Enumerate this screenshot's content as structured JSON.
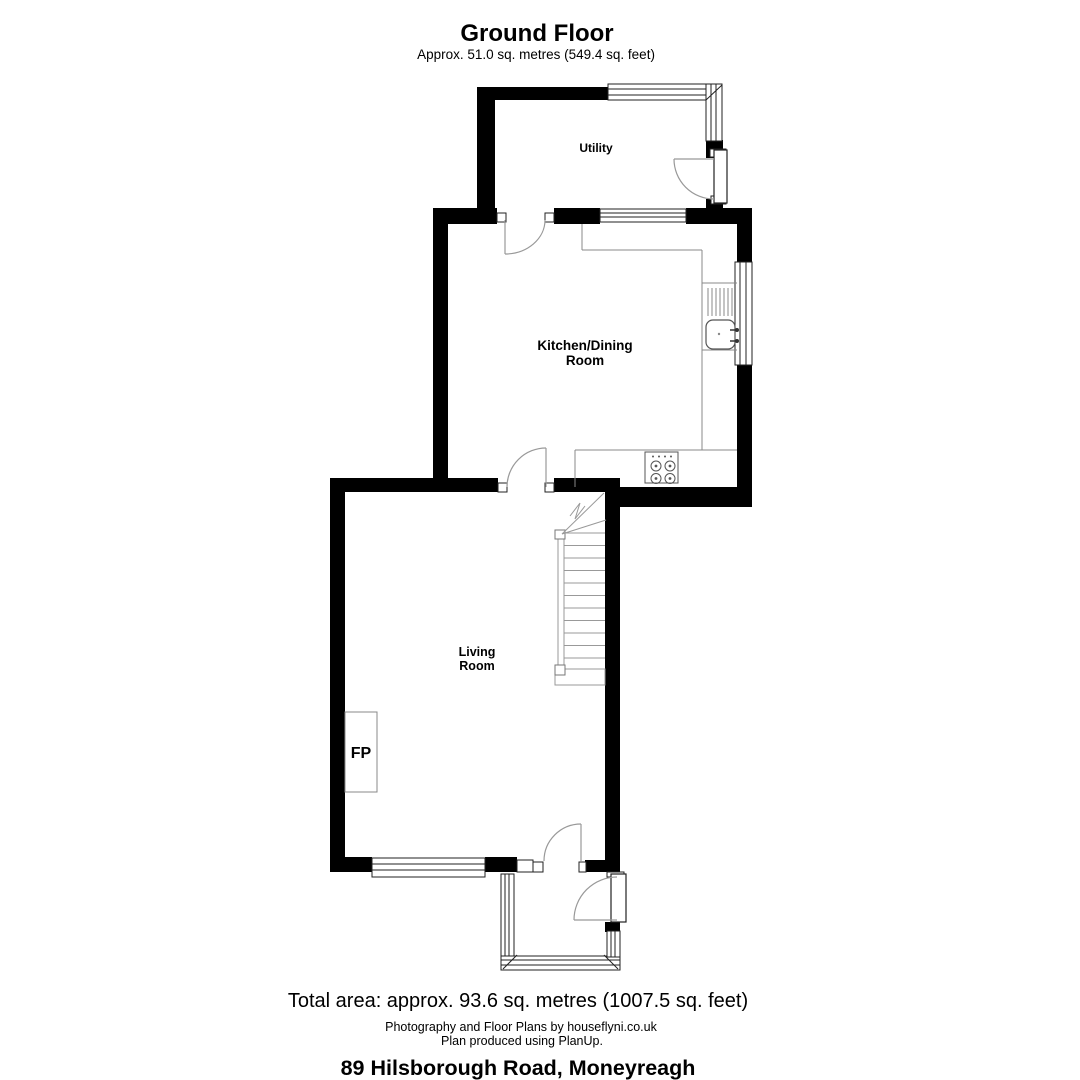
{
  "title": {
    "floor_name": "Ground Floor",
    "floor_area": "Approx. 51.0 sq. metres (549.4 sq. feet)"
  },
  "rooms": {
    "utility": {
      "name": "Utility"
    },
    "kitchen_dining": {
      "name_line1": "Kitchen/Dining",
      "name_line2": "Room"
    },
    "living": {
      "name_line1": "Living",
      "name_line2": "Room"
    },
    "fireplace": {
      "abbr": "FP"
    }
  },
  "fixtures": {
    "sink": "sink-with-drainer",
    "hob": "four-ring-hob",
    "stairs": "staircase-up",
    "front_door": "entrance-door",
    "back_door": "utility-external-door"
  },
  "footer": {
    "total_area": "Total area: approx. 93.6 sq. metres (1007.5 sq. feet)",
    "credit_photography": "Photography and Floor Plans by houseflyni.co.uk",
    "credit_software": "Plan produced using PlanUp.",
    "address": "89 Hilsborough Road, Moneyreagh"
  },
  "colors": {
    "wall": "#000000",
    "frame": "#222222",
    "fixture_line": "#777777",
    "arc_line": "#999999",
    "background": "#ffffff",
    "text": "#000000"
  }
}
